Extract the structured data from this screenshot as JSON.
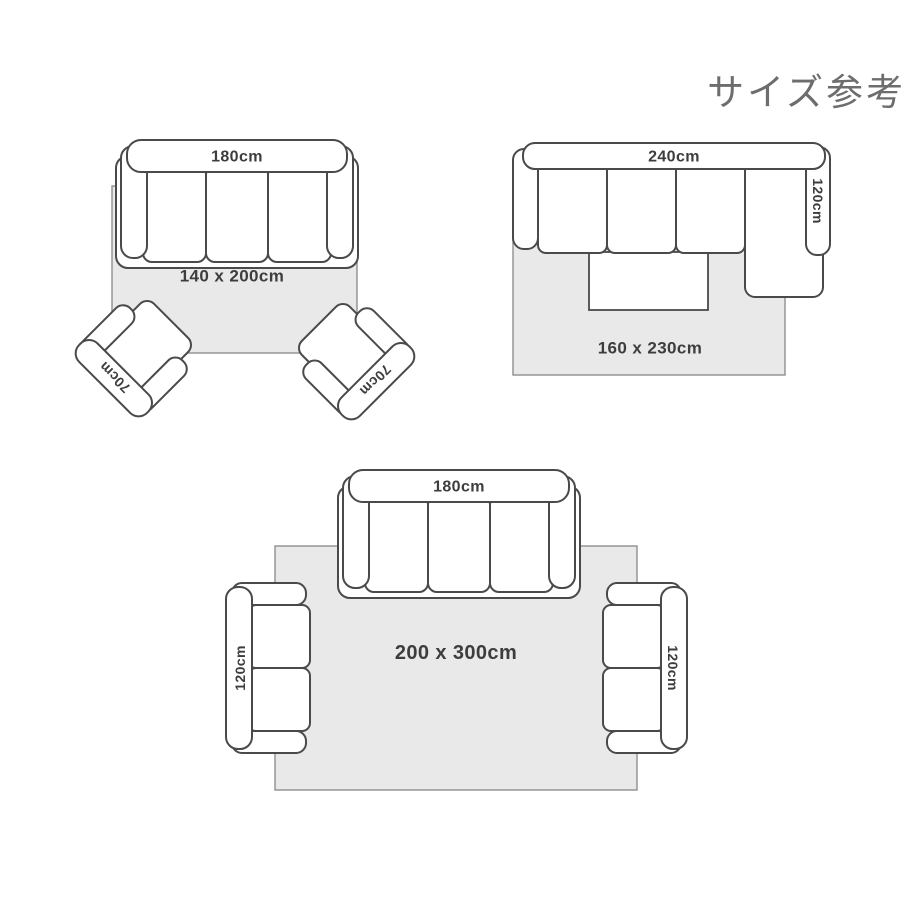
{
  "header": {
    "title": "サイズ参考"
  },
  "colors": {
    "background": "#ffffff",
    "furniture_fill": "#ffffff",
    "furniture_outline": "#4a4a4a",
    "rug_fill": "#e9e9e9",
    "rug_outline": "#8f8f8f",
    "label_text": "#3d3d3d",
    "title_text": "#6d6d6d"
  },
  "diagrams": [
    {
      "name": "rug 140x200 with three-seat sofa and two armchairs",
      "rug": {
        "label": "140 x 200cm"
      },
      "sofa": {
        "type": "three-seat-sofa",
        "label": "180cm"
      },
      "chairs": [
        {
          "label": "70cm"
        },
        {
          "label": "70cm"
        }
      ]
    },
    {
      "name": "rug 160x230 with L-shaped sectional and coffee table",
      "rug": {
        "label": "160 x 230cm"
      },
      "sofa": {
        "type": "l-shaped-sectional",
        "label": "240cm",
        "chaise_label": "120cm"
      }
    },
    {
      "name": "rug 200x300 with three-seat sofa and two loveseats",
      "rug": {
        "label": "200 x 300cm"
      },
      "sofa": {
        "type": "three-seat-sofa",
        "label": "180cm"
      },
      "loveseats": [
        {
          "label": "120cm"
        },
        {
          "label": "120cm"
        }
      ]
    }
  ]
}
